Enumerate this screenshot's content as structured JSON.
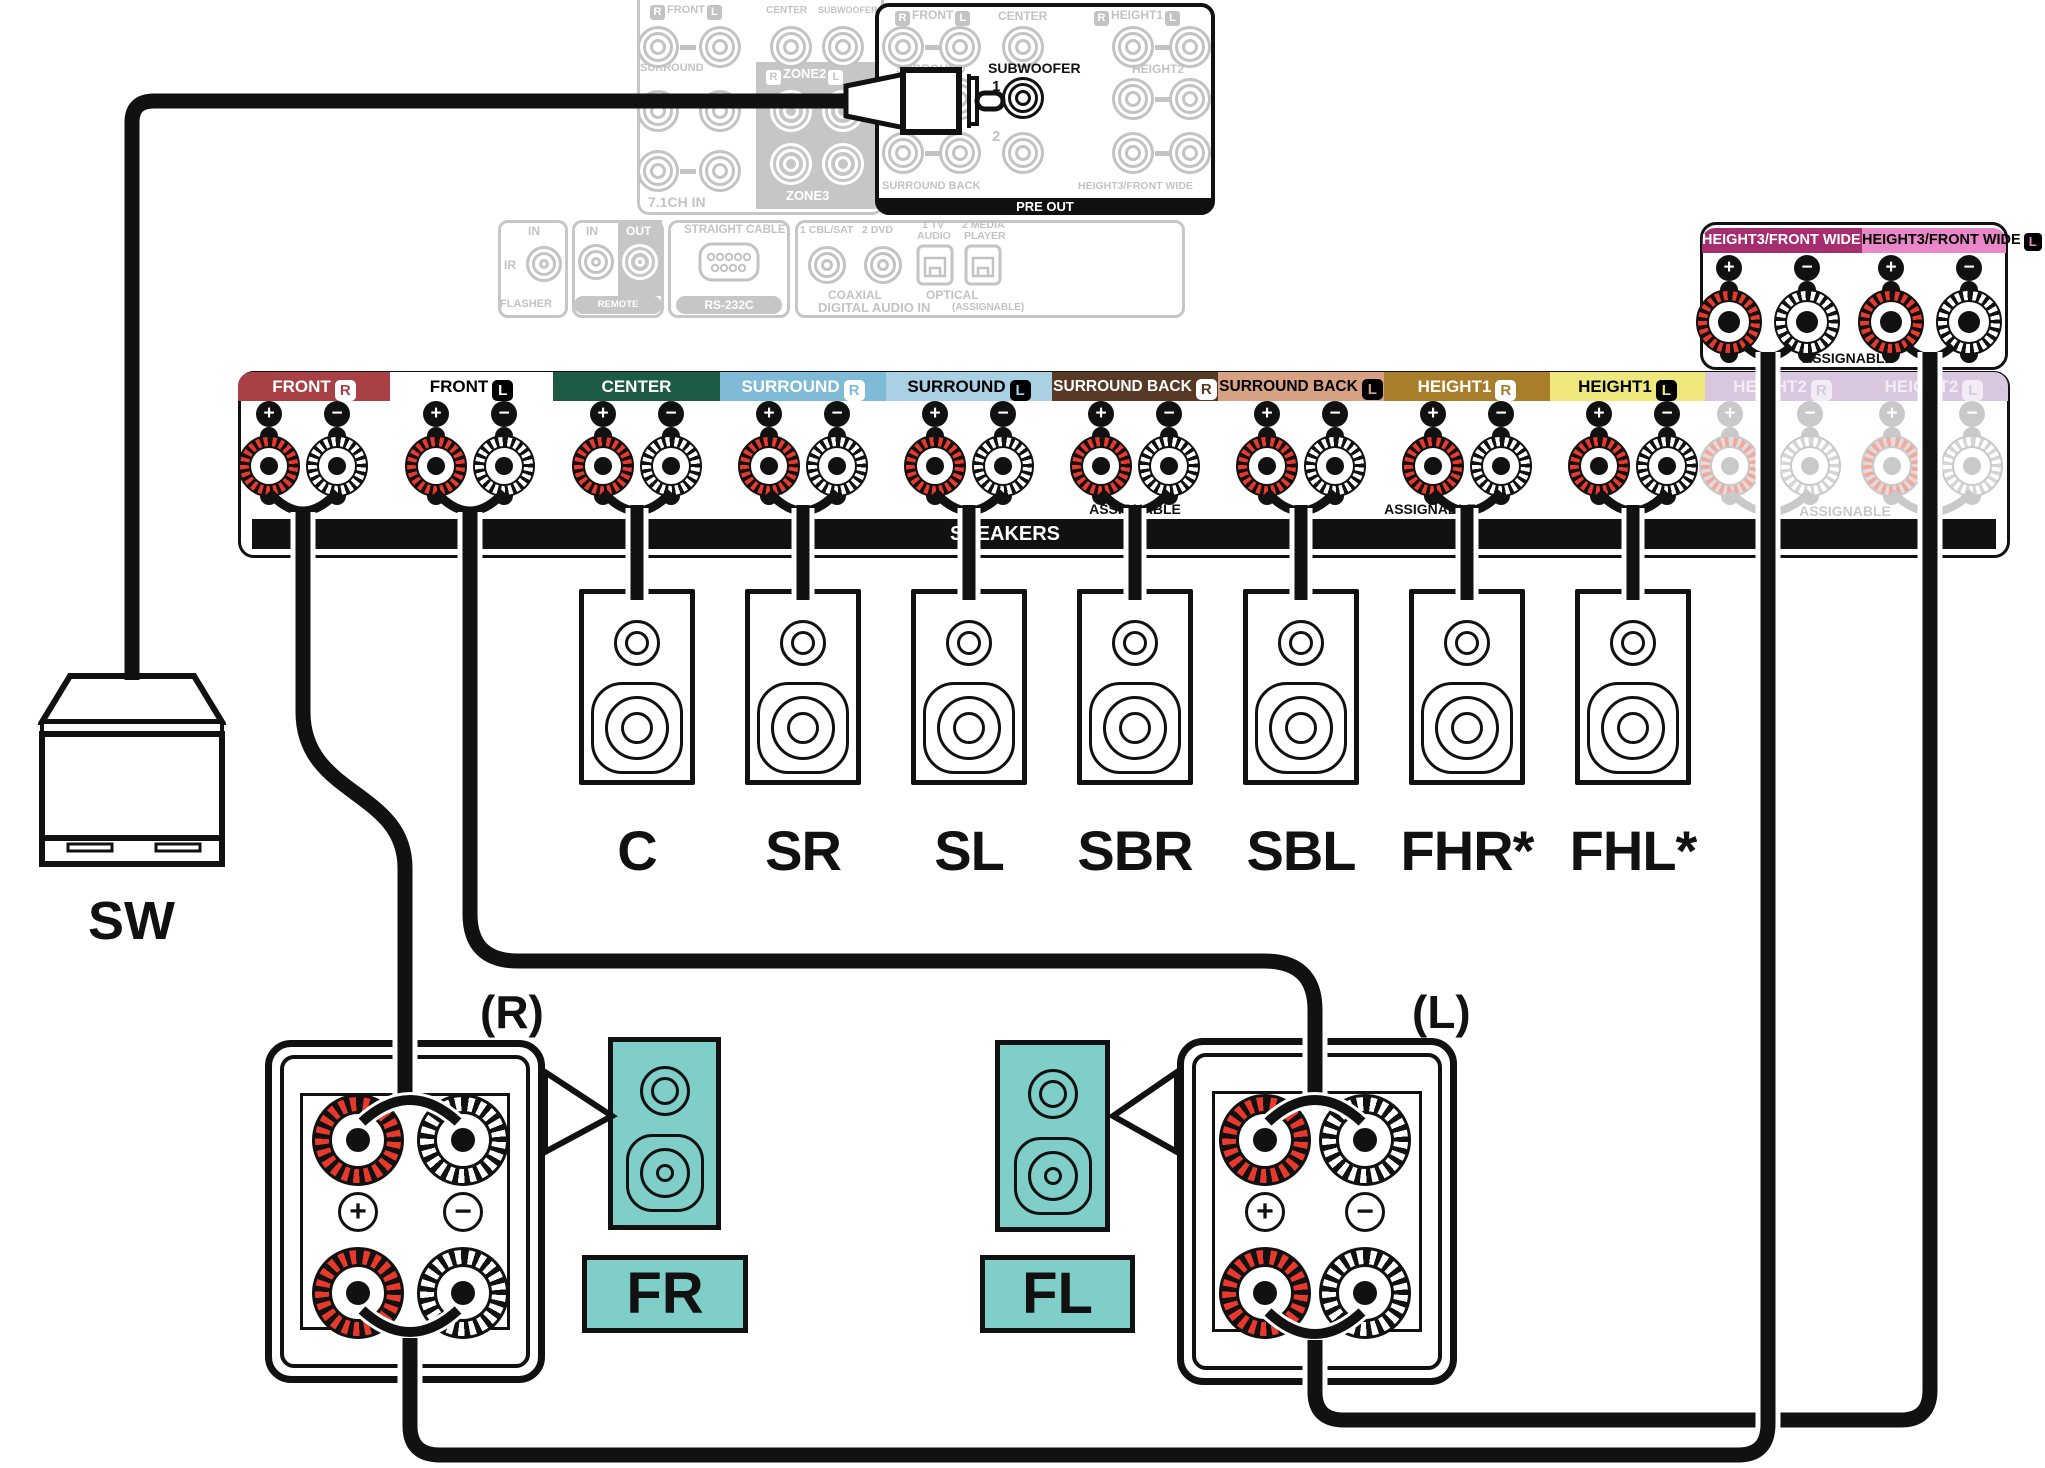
{
  "glyphs": {
    "plus": "+",
    "minus": "−"
  },
  "colors": {
    "post_red": "#E8392C",
    "post_red_grayed": "#F4A79B",
    "teal": "#7FCEC8",
    "panel_gray": "#C6C6C6",
    "text_gray": "#C3C3C3",
    "black": "#111111"
  },
  "panel_71ch": {
    "r": "R",
    "front": "FRONT",
    "l": "L",
    "center": "CENTER",
    "subwoofer": "SUBWOOFER",
    "surround": "SURROUND",
    "zone2_r": "R",
    "zone2": "ZONE2",
    "zone2_l": "L",
    "zone3": "ZONE3",
    "caption": "7.1CH IN"
  },
  "pre_out": {
    "r": "R",
    "front": "FRONT",
    "l": "L",
    "center": "CENTER",
    "h1_r": "R",
    "height1": "HEIGHT1",
    "h1_l": "L",
    "surround": "SURROUND",
    "subwoofer": "SUBWOOFER",
    "num1": "1",
    "num2": "2",
    "height2": "HEIGHT2",
    "surround_back": "SURROUND BACK",
    "height3": "HEIGHT3/FRONT WIDE",
    "caption": "PRE OUT"
  },
  "io": {
    "flasher": {
      "in_label": "IN",
      "ir": "IR",
      "caption": "FLASHER"
    },
    "remote": {
      "in_label": "IN",
      "out_label": "OUT",
      "caption": "REMOTE CONTROL"
    },
    "rs232": {
      "top": "STRAIGHT CABLE",
      "caption": "RS-232C"
    },
    "digital": {
      "cbl": "1 CBL/SAT",
      "dvd": "2 DVD",
      "tv_1": "1 TV",
      "tv_2": "AUDIO",
      "media_1": "2 MEDIA",
      "media_2": "PLAYER",
      "coaxial": "COAXIAL",
      "optical": "OPTICAL",
      "caption": "DIGITAL AUDIO IN",
      "assignable": "(ASSIGNABLE)"
    }
  },
  "height3": {
    "r_label": "HEIGHT3/FRONT WIDE",
    "r_rl": "R",
    "r_bg": "#A62D6E",
    "r_fg": "#FFFFFF",
    "l_label": "HEIGHT3/FRONT WIDE",
    "l_rl": "L",
    "l_bg": "#E987C8",
    "l_fg": "#000000",
    "assignable": "ASSIGNABLE"
  },
  "row": {
    "channels": [
      {
        "label": "FRONT",
        "rl": "R",
        "bg": "#A84046",
        "fg": "#FFFFFF"
      },
      {
        "label": "FRONT",
        "rl": "L",
        "bg": "#FFFFFF",
        "fg": "#000000"
      },
      {
        "label": "CENTER",
        "rl": "",
        "bg": "#1E5B44",
        "fg": "#FFFFFF"
      },
      {
        "label": "SURROUND",
        "rl": "R",
        "bg": "#7FBAD6",
        "fg": "#FFFFFF"
      },
      {
        "label": "SURROUND",
        "rl": "L",
        "bg": "#A9D0E3",
        "fg": "#000000"
      },
      {
        "label": "SURROUND BACK",
        "rl": "R",
        "bg": "#583926",
        "fg": "#FFFFFF"
      },
      {
        "label": "SURROUND BACK",
        "rl": "L",
        "bg": "#D7A183",
        "fg": "#000000"
      },
      {
        "label": "HEIGHT1",
        "rl": "R",
        "bg": "#A97E2B",
        "fg": "#FFFFFF"
      },
      {
        "label": "HEIGHT1",
        "rl": "L",
        "bg": "#EEE87D",
        "fg": "#000000"
      },
      {
        "label": "HEIGHT2",
        "rl": "R",
        "bg": "#D9C6DF",
        "fg": "#F2EDF5"
      },
      {
        "label": "HEIGHT2",
        "rl": "L",
        "bg": "#D9C6DF",
        "fg": "#F2EDF5"
      }
    ],
    "speakers_bar": "SPEAKERS",
    "assignable": "ASSIGNABLE"
  },
  "speakers": {
    "c": "C",
    "sr": "SR",
    "sl": "SL",
    "sbr": "SBR",
    "sbl": "SBL",
    "fhr": "FHR*",
    "fhl": "FHL*"
  },
  "bottom": {
    "sw": "SW",
    "r": "(R)",
    "l": "(L)",
    "fr": "FR",
    "fl": "FL"
  }
}
